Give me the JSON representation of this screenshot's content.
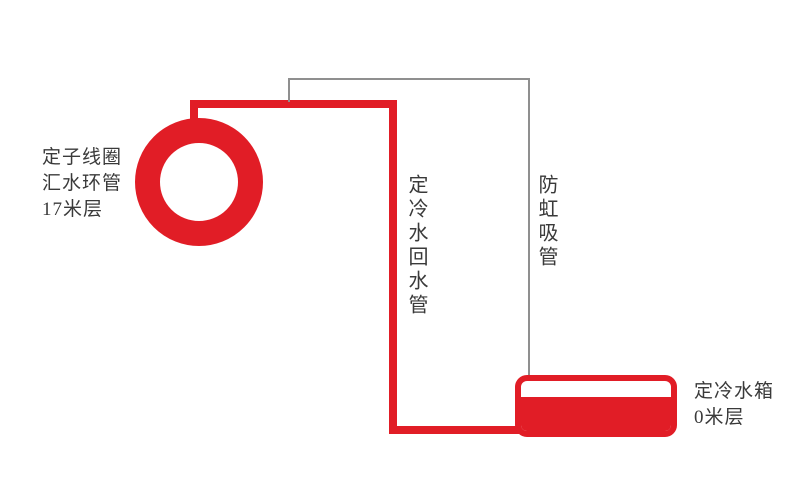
{
  "diagram": {
    "ring_label": "定子线圈\n汇水环管\n17米层",
    "return_pipe_label": "定冷水回水管",
    "anti_siphon_label": "防虹吸管",
    "tank_label": "定冷水箱\n0米层",
    "colors": {
      "pipe_red": "#e11d26",
      "anti_siphon_gray": "#8f8f8f",
      "text": "#3a3a3a",
      "background": "#ffffff"
    }
  }
}
